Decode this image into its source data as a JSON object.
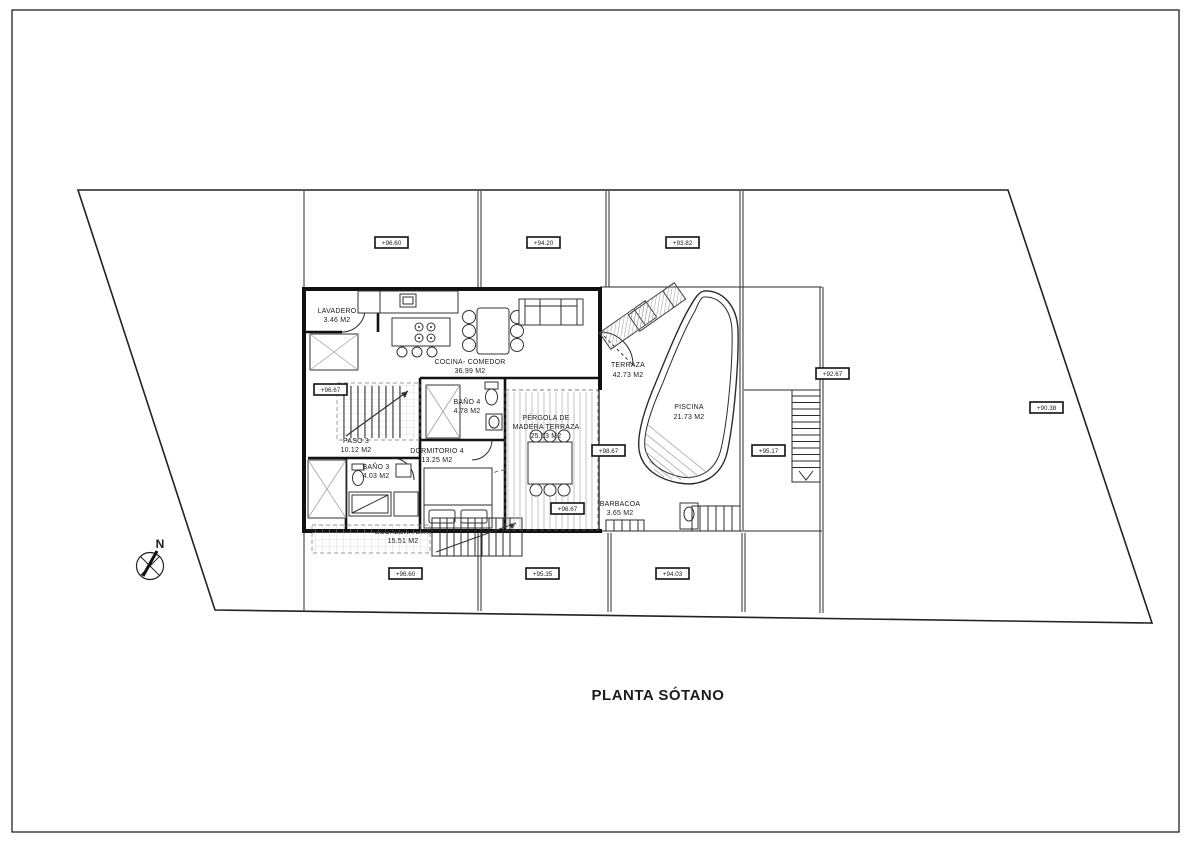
{
  "title": "PLANTA SÓTANO",
  "compass": {
    "icon": "north-compass-icon",
    "north_label": "N"
  },
  "colors": {
    "line": "#1c1c1c",
    "paper": "#ffffff",
    "hatch": "#9a9a9a"
  },
  "rooms": {
    "lavadero": {
      "name": "LAVADERO",
      "area": "3.46 M2"
    },
    "cocina": {
      "name": "COCINA- COMEDOR",
      "area": "36.99 M2"
    },
    "bano4": {
      "name": "BAÑO 4",
      "area": "4.78 M2"
    },
    "paso3": {
      "name": "PASO 3",
      "area": "10.12 M2"
    },
    "dormitorio4": {
      "name": "DORMITORIO 4",
      "area": "13.25 M2"
    },
    "bano3": {
      "name": "BAÑO 3",
      "area": "4.03 M2"
    },
    "escalera_ext": {
      "name": "ESCALERA EXT.",
      "area": "15.51 M2"
    },
    "pergola": {
      "line1": "PÉRGOLA DE",
      "line2": "MADERA TERRAZA",
      "area": "25.63 M2"
    },
    "barbacoa": {
      "name": "BARBACOA",
      "area": "3.65 M2"
    },
    "terraza": {
      "name": "TERRAZA",
      "area": "42.73 M2"
    },
    "piscina": {
      "name": "PISCINA",
      "area": "21.73 M2"
    }
  },
  "markers": {
    "top_left": "+96.60",
    "top_mid": "+94.20",
    "top_right": "+93.82",
    "interior_stair": "+96.67",
    "terraza_deck": "+98.67",
    "barbacoa_deck": "+96.67",
    "garden_right_upper": "+92.67",
    "garden_right_mid": "+95.17",
    "plot_far_right": "+90.38",
    "bottom_left": "+96.60",
    "bottom_mid": "+95.35",
    "bottom_right": "+94.03"
  }
}
